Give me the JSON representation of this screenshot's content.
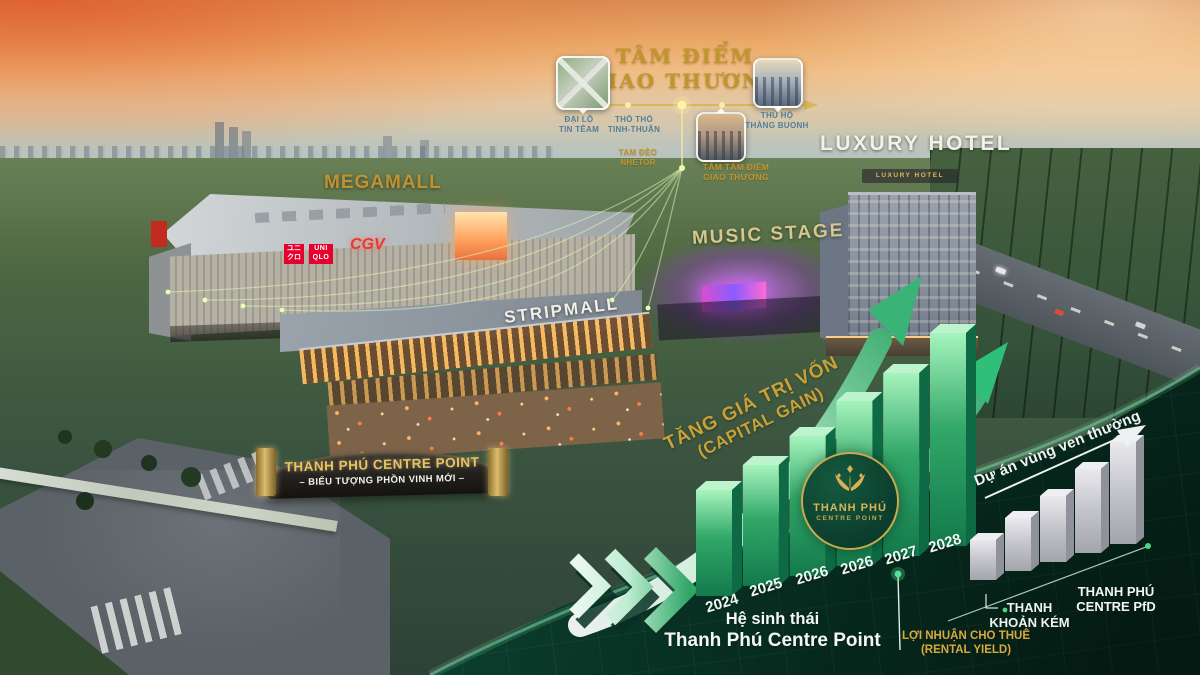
{
  "meta": {
    "description": "Aerial sunset marketing visual of Thanh Phu Centre Point complex with investment infographic"
  },
  "colors": {
    "accent_gold": "#c2952e",
    "accent_green": "#2fa566",
    "panel_green": "#0d4936",
    "bar_gray": "#c6c7cc",
    "sign_red": "#e6002d"
  },
  "hub": {
    "title_line1": "TÂM ĐIỂM",
    "title_line2": "GIAO THƯƠNG",
    "nodes": [
      {
        "line1": "ĐẠI LỘ",
        "line2": "TIN TÊAM"
      },
      {
        "line1": "THỔ THỔ",
        "line2": "TINH-THUẬN"
      },
      {
        "line1": "TAM ĐÈO",
        "line2": "NHETOR"
      },
      {
        "line1": "TÂM TÂM ĐIỂM",
        "line2": "GIAO THƯƠNG"
      },
      {
        "line1": "THỦ HỘ",
        "line2": "THÀNG BUONH"
      }
    ]
  },
  "labels": {
    "megamall": "MEGAMALL",
    "luxury_hotel": "LUXURY HOTEL",
    "music_stage": "MUSIC STAGE",
    "stripmall": "STRIPMALL"
  },
  "signs": {
    "uniqlo_jp": "ユニクロ",
    "uniqlo": "UNI QLO",
    "cgv": "CGV",
    "hotel_roof": "LUXURY HOTEL"
  },
  "gate": {
    "line1": "THANH PHÚ CENTRE POINT",
    "line2": "– BIỂU TƯỢNG PHỒN VINH MỚI –"
  },
  "logo": {
    "line1": "THANH PHÚ",
    "line2": "CENTRE POINT"
  },
  "captions": {
    "capital_gain_line1": "TĂNG GIÁ TRỊ VỐN",
    "capital_gain_line2": "(CAPITAL GAIN)",
    "ecosystem_line1": "Hệ sinh thái",
    "ecosystem_line2": "Thanh Phú Centre Point",
    "rental_line1": "LỢI NHUẬN CHO THUÊ",
    "rental_line2": "(RENTAL YIELD)",
    "liquidity_line1": "THANH",
    "liquidity_line2": "KHOẢN KÉM",
    "tp_line1": "THANH PHÚ",
    "tp_line2": "CENTRE PfD"
  },
  "chart_data": [
    {
      "type": "bar",
      "title": "TĂNG GIÁ TRỊ VỐN (CAPITAL GAIN)",
      "categories": [
        "2024",
        "2025",
        "2026",
        "2026",
        "2027",
        "2028"
      ],
      "values": [
        106,
        121,
        140,
        165,
        183,
        213
      ],
      "unit": "relative bar height, no numeric axis shown",
      "color": "#2fa566",
      "legend_position": "none",
      "annotations": [
        "THANH PHÚ CENTRE POINT circular logo over bars",
        "two rising green arrows"
      ]
    },
    {
      "type": "bar",
      "title": "Dự án vùng ven thường",
      "categories": [
        "",
        "",
        "",
        "",
        ""
      ],
      "values": [
        40,
        53,
        66,
        84,
        102
      ],
      "unit": "relative bar height, no numeric axis shown",
      "color": "#c6c7cc",
      "legend_position": "none",
      "annotations": [
        "THANH KHOẢN KÉM",
        "THANH PHÚ CENTRE PfD",
        "LỢI NHUẬN CHO THUÊ (RENTAL YIELD)"
      ]
    }
  ]
}
